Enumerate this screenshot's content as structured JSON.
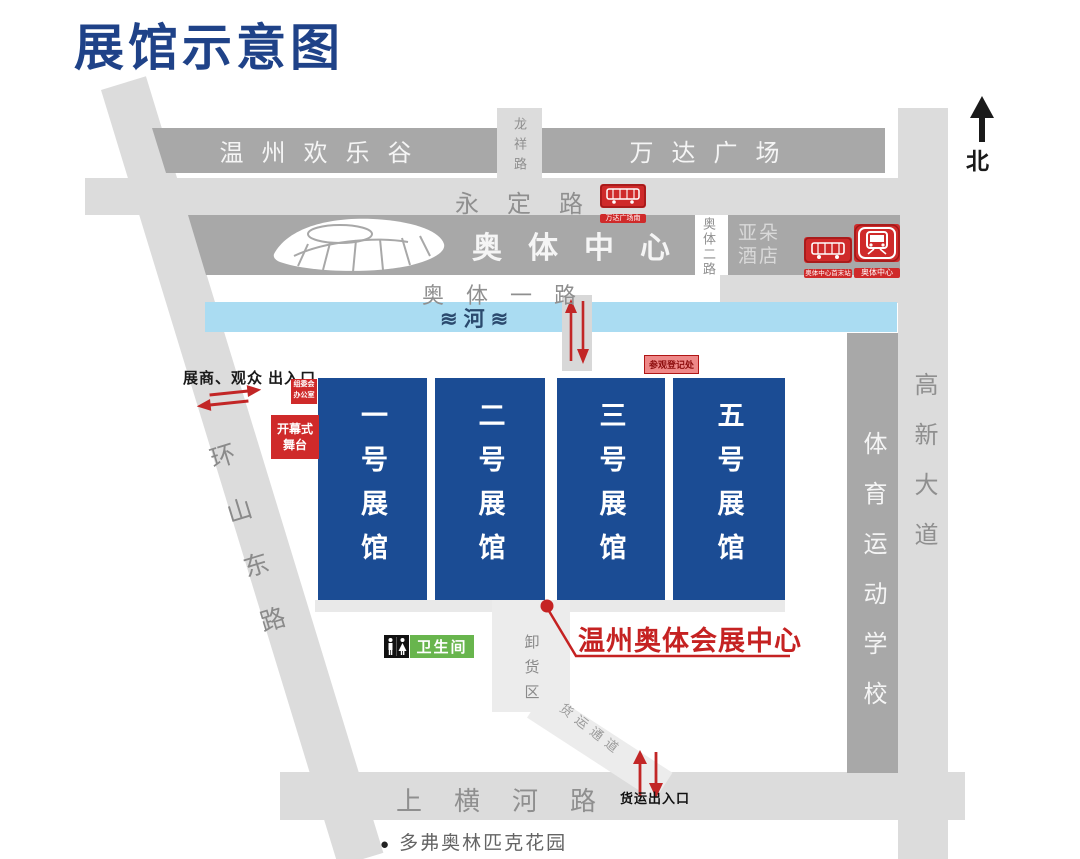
{
  "title": "展馆示意图",
  "compass": "北",
  "colors": {
    "title_blue": "#1f4288",
    "hall_blue": "#1b4c94",
    "river_blue": "#aadcf2",
    "road_dark_gray": "#a8a8a8",
    "road_light_gray": "#dcdcdc",
    "marker_red": "#cf2a2a",
    "toilet_green": "#68b54d"
  },
  "roads": {
    "happy_valley": "温州欢乐谷",
    "longxiang_road": "龙祥路",
    "wanda_plaza": "万达广场",
    "yongding_road": "永定路",
    "aoti_center": "奥体中心",
    "aoti_2nd_road": "奥体二路",
    "atour_line1": "亚朵",
    "atour_line2": "酒店",
    "aoti_1st_road": "奥体一路",
    "river_label": "≋河≋",
    "huanshan_east_road": "环山东路",
    "sports_school": "体育运动学校",
    "gaoxin_avenue": "高新大道",
    "shanghenghe_road": "上横河路",
    "dove_garden": "多弗奥林匹克花园"
  },
  "halls": [
    {
      "label": "一号展馆"
    },
    {
      "label": "二号展馆"
    },
    {
      "label": "三号展馆"
    },
    {
      "label": "五号展馆"
    }
  ],
  "markers": {
    "exhibitor_visitor_entrance": "展商、观众 出入口",
    "committee_office_line1": "组委会",
    "committee_office_line2": "办公室",
    "opening_stage_line1": "开幕式",
    "opening_stage_line2": "舞台",
    "visitor_registration": "参观登记处",
    "expo_center_name": "温州奥体会展中心",
    "toilet": "卫生间",
    "unloading_area": "卸货区",
    "freight_corridor": "货运通道",
    "freight_gate": "货运出入口",
    "wanda_south_stop": "万达广场南",
    "brt_terminal": "奥体中心首末站",
    "metro_station": "奥体中心"
  }
}
